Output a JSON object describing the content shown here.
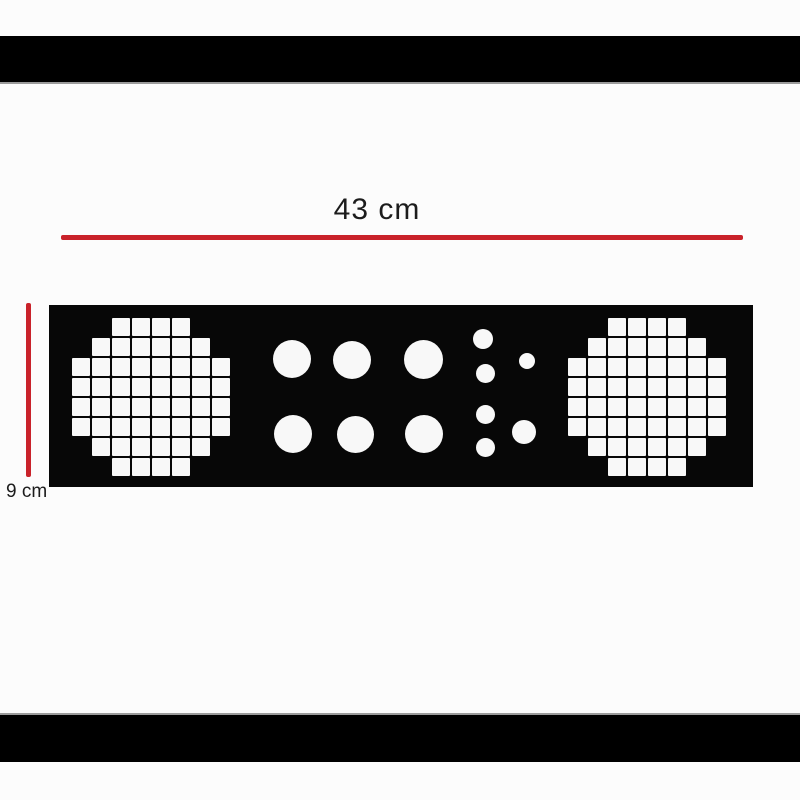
{
  "image": {
    "background": "#fcfcfc",
    "letterbox_band_color": "#000000"
  },
  "annotations": {
    "width_label": "43 cm",
    "height_label": "9 cm",
    "line_color": "#c9222a",
    "text_color": "#1c1c1c"
  },
  "stencil": {
    "panel_color": "#070707",
    "hole_color": "#f8f8f8",
    "grid_columns": 8,
    "square_grids": [
      {
        "side": "left",
        "origin_x": 23,
        "origin_y": 13,
        "cell": 17.5,
        "gap": 2.5,
        "row_counts": [
          4,
          6,
          8,
          8,
          8,
          8,
          6,
          4
        ]
      },
      {
        "side": "right",
        "origin_x": 519,
        "origin_y": 13,
        "cell": 17.5,
        "gap": 2.5,
        "row_counts": [
          4,
          6,
          8,
          8,
          8,
          8,
          6,
          4
        ]
      }
    ],
    "round_holes": [
      {
        "cx": 243,
        "cy": 54,
        "d": 38
      },
      {
        "cx": 303,
        "cy": 55,
        "d": 38
      },
      {
        "cx": 374,
        "cy": 54,
        "d": 39
      },
      {
        "cx": 244,
        "cy": 129,
        "d": 38
      },
      {
        "cx": 306,
        "cy": 129,
        "d": 37
      },
      {
        "cx": 375,
        "cy": 129,
        "d": 38
      },
      {
        "cx": 434,
        "cy": 34,
        "d": 20
      },
      {
        "cx": 436,
        "cy": 68,
        "d": 19
      },
      {
        "cx": 436,
        "cy": 109,
        "d": 19
      },
      {
        "cx": 436,
        "cy": 142,
        "d": 19
      },
      {
        "cx": 478,
        "cy": 56,
        "d": 16
      },
      {
        "cx": 475,
        "cy": 127,
        "d": 24
      }
    ]
  }
}
